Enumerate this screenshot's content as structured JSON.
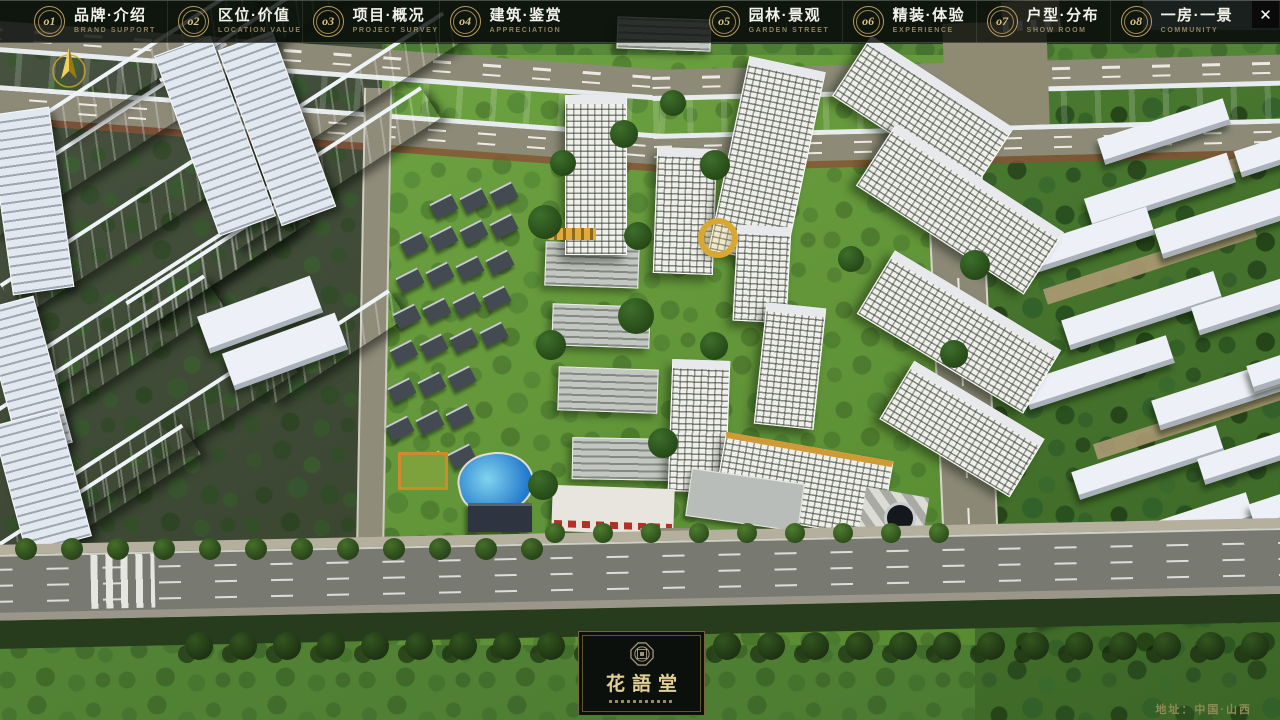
{
  "window_controls": {
    "close_glyph": "✕"
  },
  "nav": {
    "items": [
      {
        "num": "o1",
        "zh": "品牌·介绍",
        "en": "BRAND SUPPORT"
      },
      {
        "num": "o2",
        "zh": "区位·价值",
        "en": "LOCATION VALUE"
      },
      {
        "num": "o3",
        "zh": "项目·概况",
        "en": "PROJECT SURVEY"
      },
      {
        "num": "o4",
        "zh": "建筑·鉴赏",
        "en": "APPRECIATION"
      },
      {
        "num": "o5",
        "zh": "园林·景观",
        "en": "GARDEN STREET"
      },
      {
        "num": "o6",
        "zh": "精装·体验",
        "en": "EXPERIENCE"
      },
      {
        "num": "o7",
        "zh": "户型·分布",
        "en": "SHOW ROOM"
      },
      {
        "num": "o8",
        "zh": "一房·一景",
        "en": "COMMUNITY"
      }
    ]
  },
  "logo": {
    "title": "花語堂"
  },
  "footer": {
    "address": "地址：中国·山西"
  },
  "colors": {
    "gold": "#c7a465",
    "bar_bg": "rgba(11,15,11,0.82)",
    "river": "#2450c8",
    "grass": "#69a03e"
  }
}
